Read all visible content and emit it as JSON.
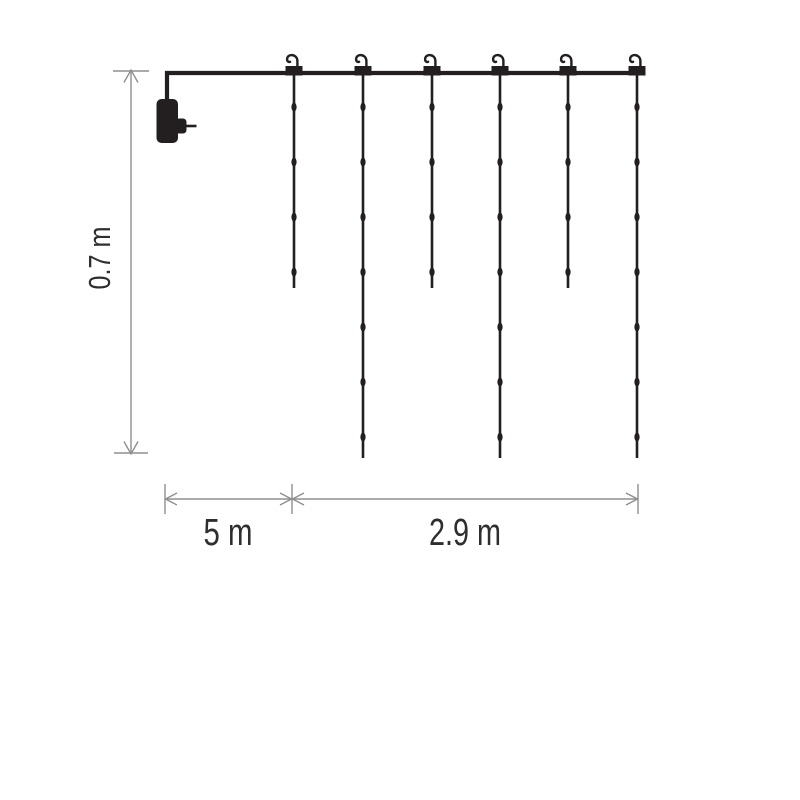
{
  "title": "Light curtain dimension diagram",
  "colors": {
    "ink": "#231f20",
    "dimension": "#8f8f8f",
    "text": "#2e2e2e",
    "background": "#ffffff"
  },
  "dimensions": {
    "height_label": "0.7 m",
    "lead_label": "5 m",
    "width_label": "2.9 m"
  },
  "curtain": {
    "wire": {
      "x1": 165,
      "x2": 645.5,
      "y": 73
    },
    "plug": {
      "x": 156.5,
      "y": 99
    },
    "first_led_y": 107,
    "led_spacing": 55,
    "strands": [
      {
        "x": 294,
        "led_count": 4,
        "tip_y": 288
      },
      {
        "x": 363,
        "led_count": 7,
        "tip_y": 458
      },
      {
        "x": 432,
        "led_count": 4,
        "tip_y": 288
      },
      {
        "x": 500,
        "led_count": 7,
        "tip_y": 458
      },
      {
        "x": 568,
        "led_count": 4,
        "tip_y": 288
      },
      {
        "x": 637,
        "led_count": 7,
        "tip_y": 458
      }
    ]
  },
  "dimension_geometry": {
    "vertical": {
      "line": [
        131,
        71,
        131,
        453
      ],
      "end_bars": [
        [
          113,
          71,
          149,
          71
        ],
        [
          114,
          453,
          148,
          453
        ]
      ],
      "arrows": [
        "124,82.5 131,70 138,82.5",
        "124,441.5 131,454 138,441.5"
      ],
      "label_pos": [
        110,
        258
      ]
    },
    "horizontal": {
      "line": [
        165,
        499,
        638,
        499
      ],
      "ticks": [
        165,
        292,
        638
      ],
      "tick_y": [
        484,
        514
      ],
      "arrows": [
        "177,493 165.5,499 177,505",
        "280,493 291.5,499 280,505",
        "304,493 292.5,499 304,505",
        "626,493 637.5,499 626,505"
      ],
      "lead_label_pos": [
        228,
        545
      ],
      "width_label_pos": [
        465,
        545
      ]
    }
  }
}
